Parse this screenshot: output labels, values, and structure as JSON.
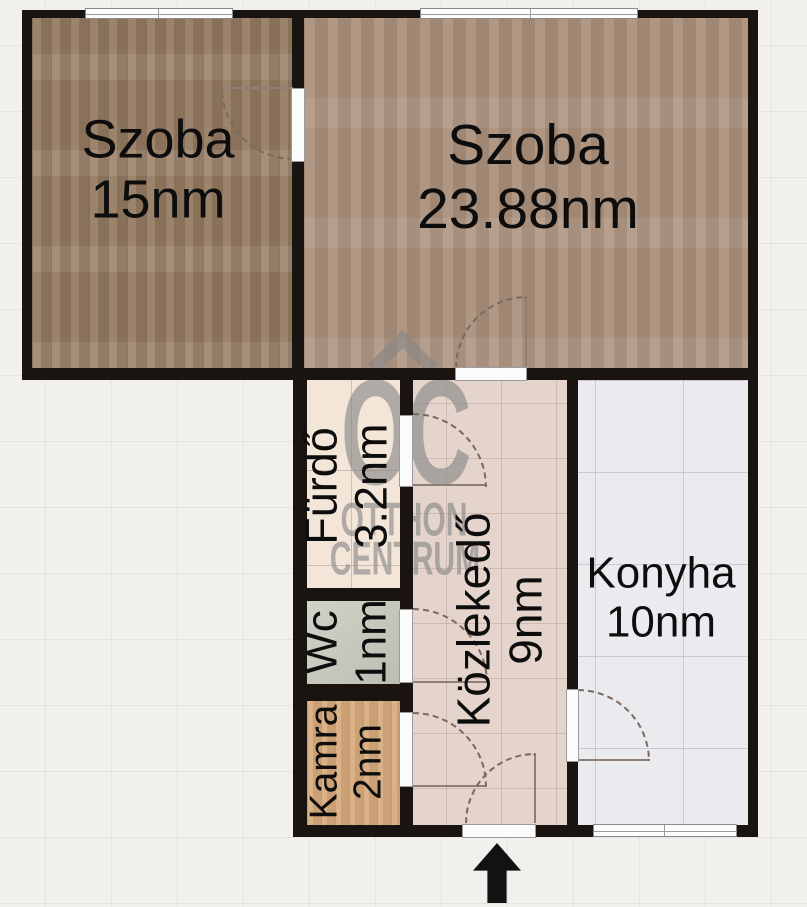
{
  "rooms": {
    "szoba1": {
      "name": "Szoba",
      "area": "15nm"
    },
    "szoba2": {
      "name": "Szoba",
      "area": "23.88nm"
    },
    "furdo": {
      "name": "Fürdő",
      "area": "3.2nm"
    },
    "wc": {
      "name": "Wc",
      "area": "1nm"
    },
    "kamra": {
      "name": "Kamra",
      "area": "2nm"
    },
    "kozlekedo": {
      "name": "Közlekedő",
      "area": "9nm"
    },
    "konyha": {
      "name": "Konyha",
      "area": "10nm"
    }
  },
  "watermark": {
    "logo": "OC",
    "brand_line1": "OTTHON",
    "brand_line2": "CENTRUM"
  },
  "icons": {
    "entrance_arrow": "up-arrow",
    "watermark_roof": "house-roof-chevron"
  },
  "colors": {
    "wall": "#1a1410",
    "background": "#f2f0ec",
    "watermark": "#868686",
    "room1_floor": "#957b61",
    "room2_floor": "#a98f7b",
    "furdo_floor": "#f3e6d8",
    "wc_floor": "#c6c8bc",
    "kamra_floor": "#d7a97b",
    "kozlekedo_floor": "#e4d4cc",
    "konyha_floor": "#eaeaef"
  }
}
